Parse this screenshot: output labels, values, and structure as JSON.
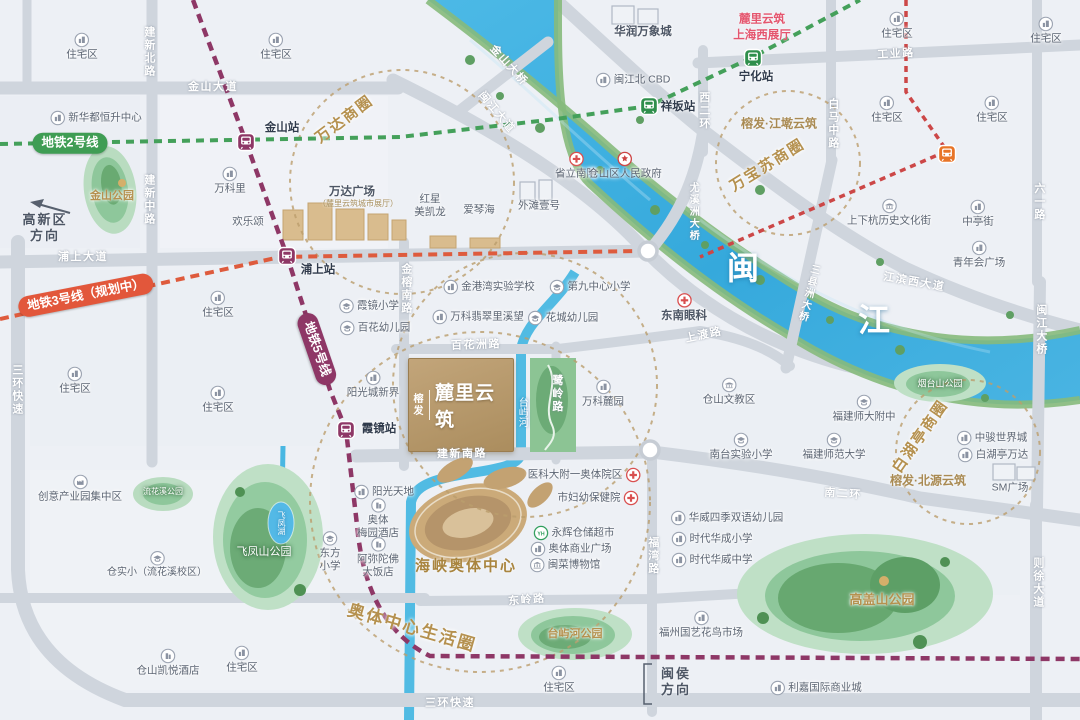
{
  "property": {
    "developer": "榕发",
    "name": "麓里云筑"
  },
  "colors": {
    "metro_line2": "#3f9d54",
    "metro_line3": "#e2573b",
    "metro_line5": "#8e3766",
    "river": "#49b7e2",
    "brand_gold": "#b5986b",
    "business_circle": "#b5914f"
  },
  "labels": [
    {
      "t": "金山大道",
      "x": 213,
      "y": 88,
      "c": "road",
      "n": "road-jinshan-avenue"
    },
    {
      "t": "建新北路",
      "x": 148,
      "y": 52,
      "c": "roadv"
    },
    {
      "t": "建新中路",
      "x": 148,
      "y": 200,
      "c": "roadv"
    },
    {
      "t": "浦上大道",
      "x": 83,
      "y": 258,
      "c": "road"
    },
    {
      "t": "三环快速",
      "x": 16,
      "y": 390,
      "c": "roadv"
    },
    {
      "t": "三环快速",
      "x": 450,
      "y": 704,
      "c": "road"
    },
    {
      "t": "金榕南路",
      "x": 405,
      "y": 289,
      "c": "roadv"
    },
    {
      "t": "百花洲路",
      "x": 476,
      "y": 346,
      "c": "road",
      "r": -2
    },
    {
      "t": "鹭岭路",
      "x": 556,
      "y": 394,
      "c": "roadv"
    },
    {
      "t": "建新南路",
      "x": 462,
      "y": 455,
      "c": "road",
      "r": -1
    },
    {
      "t": "东岭路",
      "x": 527,
      "y": 601,
      "c": "road",
      "r": -5
    },
    {
      "t": "福湾路",
      "x": 652,
      "y": 556,
      "c": "roadv"
    },
    {
      "t": "上渡路",
      "x": 704,
      "y": 336,
      "c": "road",
      "r": -12
    },
    {
      "t": "南二环",
      "x": 843,
      "y": 495,
      "c": "road",
      "r": 4
    },
    {
      "t": "则徐大道",
      "x": 1037,
      "y": 583,
      "c": "roadv"
    },
    {
      "t": "六一路",
      "x": 1038,
      "y": 202,
      "c": "roadv"
    },
    {
      "t": "白马中路",
      "x": 832,
      "y": 124,
      "c": "roadv"
    },
    {
      "t": "西二环",
      "x": 703,
      "y": 111,
      "c": "roadv"
    },
    {
      "t": "工业路",
      "x": 896,
      "y": 55,
      "c": "road",
      "r": -3
    },
    {
      "t": "闽江大道",
      "x": 496,
      "y": 113,
      "c": "road",
      "r": 50
    },
    {
      "t": "金山大桥",
      "x": 508,
      "y": 66,
      "c": "road",
      "r": 48
    },
    {
      "t": "尤溪洲大桥",
      "x": 692,
      "y": 212,
      "c": "roadv",
      "fs": 10
    },
    {
      "t": "三县洲大桥",
      "x": 807,
      "y": 293,
      "c": "roadv",
      "r": 14,
      "fs": 10
    },
    {
      "t": "闽江大桥",
      "x": 1040,
      "y": 330,
      "c": "roadv"
    },
    {
      "t": "江滨西大道",
      "x": 914,
      "y": 283,
      "c": "road",
      "r": 10
    },
    {
      "t": "地铁2号线",
      "x": 70,
      "y": 143,
      "c": "pill2",
      "n": "metro-line2-label"
    },
    {
      "t": "地铁3号线（规划中）",
      "x": 86,
      "y": 295,
      "c": "pill3",
      "r": -11,
      "n": "metro-line3-label"
    },
    {
      "t": "地铁5号线",
      "x": 317,
      "y": 349,
      "c": "pill5",
      "r": 71,
      "n": "metro-line5-label"
    },
    {
      "i": "m5",
      "x": 246,
      "y": 142,
      "n": "jinshan-station-icon"
    },
    {
      "t": "金山站",
      "x": 282,
      "y": 128,
      "c": "station"
    },
    {
      "i": "m5",
      "x": 287,
      "y": 256,
      "n": "pushang-station-icon"
    },
    {
      "t": "浦上站",
      "x": 318,
      "y": 270,
      "c": "station"
    },
    {
      "i": "m5",
      "x": 346,
      "y": 430,
      "n": "xiajing-station-icon"
    },
    {
      "t": "霞镜站",
      "x": 379,
      "y": 429,
      "c": "station"
    },
    {
      "i": "m2",
      "x": 753,
      "y": 58,
      "n": "ninghua-station-icon"
    },
    {
      "t": "宁化站",
      "x": 756,
      "y": 77,
      "c": "station"
    },
    {
      "i": "m2",
      "x": 649,
      "y": 106,
      "n": "xiangban-station-icon"
    },
    {
      "t": "祥坂站",
      "x": 678,
      "y": 107,
      "c": "station"
    },
    {
      "i": "mo",
      "x": 947,
      "y": 154,
      "n": "metro-station-icon"
    },
    {
      "t": "万达商圈",
      "x": 345,
      "y": 120,
      "c": "biz",
      "r": -37
    },
    {
      "t": "万宝苏商圈",
      "x": 768,
      "y": 166,
      "c": "biz",
      "r": -32
    },
    {
      "t": "白湖亭商圈",
      "x": 921,
      "y": 437,
      "c": "biz",
      "r": -55
    },
    {
      "t": "奥体中心生活圈",
      "x": 412,
      "y": 628,
      "c": "biz",
      "r": 16,
      "fs": 17
    },
    {
      "t": "闽",
      "x": 743,
      "y": 268,
      "c": "river",
      "n": "minjiang-river-label"
    },
    {
      "t": "江",
      "x": 874,
      "y": 320,
      "c": "river",
      "n": "minjiang-river-label"
    },
    {
      "t": "台屿河",
      "x": 521,
      "y": 412,
      "c": "lake"
    },
    {
      "t": "飞凤湖",
      "x": 281,
      "y": 523,
      "c": "lake",
      "fs": 8
    },
    {
      "t": "金山公园",
      "x": 112,
      "y": 197,
      "c": "parkgold",
      "fs": 11
    },
    {
      "t": "飞凤山公园",
      "x": 264,
      "y": 553,
      "c": "park"
    },
    {
      "t": "流花溪公园",
      "x": 163,
      "y": 492,
      "c": "park",
      "fs": 8
    },
    {
      "t": "台屿河公园",
      "x": 575,
      "y": 635,
      "c": "parkgold",
      "fs": 11
    },
    {
      "t": "高盖山公园",
      "x": 882,
      "y": 600,
      "c": "parkgold",
      "fs": 13,
      "n": "gaogaishan-park-label"
    },
    {
      "t": "烟台山公园",
      "x": 940,
      "y": 384,
      "c": "park",
      "fs": 9
    },
    {
      "t": "海峡奥体中心",
      "x": 466,
      "y": 567,
      "c": "goldbig",
      "n": "olympic-center-label"
    },
    {
      "t": "榕发·江墘云筑",
      "x": 779,
      "y": 124,
      "c": "gold"
    },
    {
      "t": "榕发·北源云筑",
      "x": 928,
      "y": 481,
      "c": "gold"
    },
    {
      "t": "麓里云筑\n上海西展厅",
      "x": 762,
      "y": 28,
      "c": "red",
      "n": "showroom-label"
    },
    {
      "t": "住宅区",
      "x": 82,
      "y": 47,
      "i": "b",
      "p": "T"
    },
    {
      "t": "住宅区",
      "x": 276,
      "y": 47,
      "i": "b",
      "p": "T"
    },
    {
      "t": "住宅区",
      "x": 897,
      "y": 26,
      "i": "b",
      "p": "T"
    },
    {
      "t": "住宅区",
      "x": 1046,
      "y": 31,
      "i": "b",
      "p": "T"
    },
    {
      "t": "住宅区",
      "x": 887,
      "y": 110,
      "i": "b",
      "p": "T"
    },
    {
      "t": "住宅区",
      "x": 992,
      "y": 110,
      "i": "b",
      "p": "T"
    },
    {
      "t": "住宅区",
      "x": 218,
      "y": 305,
      "i": "b",
      "p": "T"
    },
    {
      "t": "住宅区",
      "x": 75,
      "y": 381,
      "i": "b",
      "p": "T"
    },
    {
      "t": "住宅区",
      "x": 218,
      "y": 400,
      "i": "b",
      "p": "T"
    },
    {
      "t": "住宅区",
      "x": 559,
      "y": 680,
      "i": "b",
      "p": "T"
    },
    {
      "t": "住宅区",
      "x": 242,
      "y": 660,
      "i": "b",
      "p": "T"
    },
    {
      "t": "新华都恒升中心",
      "x": 96,
      "y": 118,
      "i": "b",
      "p": "L"
    },
    {
      "t": "万科里",
      "x": 230,
      "y": 181,
      "i": "b",
      "p": "T"
    },
    {
      "t": "欢乐颂",
      "x": 248,
      "y": 222
    },
    {
      "t": "万达广场",
      "x": 352,
      "y": 192,
      "c": "poibold"
    },
    {
      "t": "（麓里云筑城市展厅）",
      "x": 358,
      "y": 204,
      "c": "subgold"
    },
    {
      "t": "金港湾实验学校",
      "x": 489,
      "y": 287,
      "i": "b",
      "p": "L"
    },
    {
      "t": "第九中心小学",
      "x": 590,
      "y": 287,
      "i": "s",
      "p": "L"
    },
    {
      "t": "万科翡翠里溪望",
      "x": 478,
      "y": 317,
      "i": "b",
      "p": "L"
    },
    {
      "t": "花城幼儿园",
      "x": 563,
      "y": 318,
      "i": "s",
      "p": "L"
    },
    {
      "t": "霞镜小学",
      "x": 369,
      "y": 306,
      "i": "s",
      "p": "L"
    },
    {
      "t": "百花幼儿园",
      "x": 375,
      "y": 328,
      "i": "s",
      "p": "L"
    },
    {
      "t": "阳光城新界",
      "x": 373,
      "y": 385,
      "i": "b",
      "p": "T"
    },
    {
      "t": "东南眼科",
      "x": 684,
      "y": 308,
      "i": "h",
      "p": "T",
      "c": "poibold"
    },
    {
      "t": "省立南院",
      "x": 576,
      "y": 166,
      "i": "h",
      "p": "T"
    },
    {
      "t": "仓山区人民政府",
      "x": 625,
      "y": 166,
      "i": "g",
      "p": "T"
    },
    {
      "t": "红星\n美凯龙",
      "x": 430,
      "y": 206
    },
    {
      "t": "爱琴海",
      "x": 479,
      "y": 210
    },
    {
      "t": "外滩壹号",
      "x": 539,
      "y": 206
    },
    {
      "t": "华润万象城",
      "x": 643,
      "y": 32,
      "c": "poibold"
    },
    {
      "t": "闽江北\nCBD",
      "x": 633,
      "y": 80,
      "i": "b",
      "p": "L"
    },
    {
      "t": "青年会广场",
      "x": 979,
      "y": 255,
      "i": "b",
      "p": "T"
    },
    {
      "t": "上下杭历史文化街",
      "x": 889,
      "y": 213,
      "i": "lm",
      "p": "T"
    },
    {
      "t": "中亭街",
      "x": 978,
      "y": 214,
      "i": "b",
      "p": "T"
    },
    {
      "t": "万科麓园",
      "x": 603,
      "y": 394,
      "i": "b",
      "p": "T"
    },
    {
      "t": "仓山文教区",
      "x": 729,
      "y": 392,
      "i": "lm",
      "p": "T"
    },
    {
      "t": "医科大附一奥体院区",
      "x": 584,
      "y": 475,
      "i": "h",
      "p": "R"
    },
    {
      "t": "市妇幼保健院",
      "x": 598,
      "y": 498,
      "i": "h",
      "p": "R"
    },
    {
      "t": "永辉仓储超市",
      "x": 574,
      "y": 533,
      "i": "yh",
      "p": "L"
    },
    {
      "t": "奥体商业广场",
      "x": 571,
      "y": 549,
      "i": "b",
      "p": "L"
    },
    {
      "t": "闽菜博物馆",
      "x": 565,
      "y": 565,
      "i": "mu",
      "p": "L"
    },
    {
      "t": "阳光天地",
      "x": 384,
      "y": 492,
      "i": "b",
      "p": "L"
    },
    {
      "t": "奥体\n梅园酒店",
      "x": 378,
      "y": 519,
      "i": "ho",
      "p": "T"
    },
    {
      "t": "阿弥陀佛\n大饭店",
      "x": 378,
      "y": 558,
      "i": "ho",
      "p": "T"
    },
    {
      "t": "福建师大附中",
      "x": 864,
      "y": 409,
      "i": "s",
      "p": "T"
    },
    {
      "t": "南台实验小学",
      "x": 741,
      "y": 447,
      "i": "s",
      "p": "T"
    },
    {
      "t": "福建师范大学",
      "x": 834,
      "y": 447,
      "i": "s",
      "p": "T"
    },
    {
      "t": "中骏世界城",
      "x": 992,
      "y": 438,
      "i": "b",
      "p": "L"
    },
    {
      "t": "白湖亭万达",
      "x": 993,
      "y": 455,
      "i": "b",
      "p": "L"
    },
    {
      "t": "SM广场",
      "x": 1010,
      "y": 488
    },
    {
      "t": "华威四季双语幼儿园",
      "x": 727,
      "y": 518,
      "i": "b",
      "p": "L"
    },
    {
      "t": "时代华成小学",
      "x": 712,
      "y": 539,
      "i": "b",
      "p": "L"
    },
    {
      "t": "时代华威中学",
      "x": 712,
      "y": 560,
      "i": "b",
      "p": "L"
    },
    {
      "t": "福州国艺花鸟市场",
      "x": 701,
      "y": 625,
      "i": "b",
      "p": "T"
    },
    {
      "t": "利嘉国际商业城",
      "x": 816,
      "y": 688,
      "i": "b",
      "p": "L"
    },
    {
      "t": "创意产业园集中区",
      "x": 80,
      "y": 489,
      "i": "fa",
      "p": "T"
    },
    {
      "t": "仓实小（流花溪校区）",
      "x": 157,
      "y": 565,
      "i": "s",
      "p": "T",
      "fs": 10
    },
    {
      "t": "东方\n小学",
      "x": 330,
      "y": 552,
      "i": "s",
      "p": "T"
    },
    {
      "t": "仓山凯悦酒店",
      "x": 168,
      "y": 663,
      "i": "ho",
      "p": "T"
    },
    {
      "t": "高新区\n方向",
      "x": 45,
      "y": 228,
      "c": "dir",
      "n": "direction-gaoxinqu"
    },
    {
      "t": "闽侯\n方向",
      "x": 676,
      "y": 682,
      "c": "dir",
      "n": "direction-minhou"
    }
  ]
}
